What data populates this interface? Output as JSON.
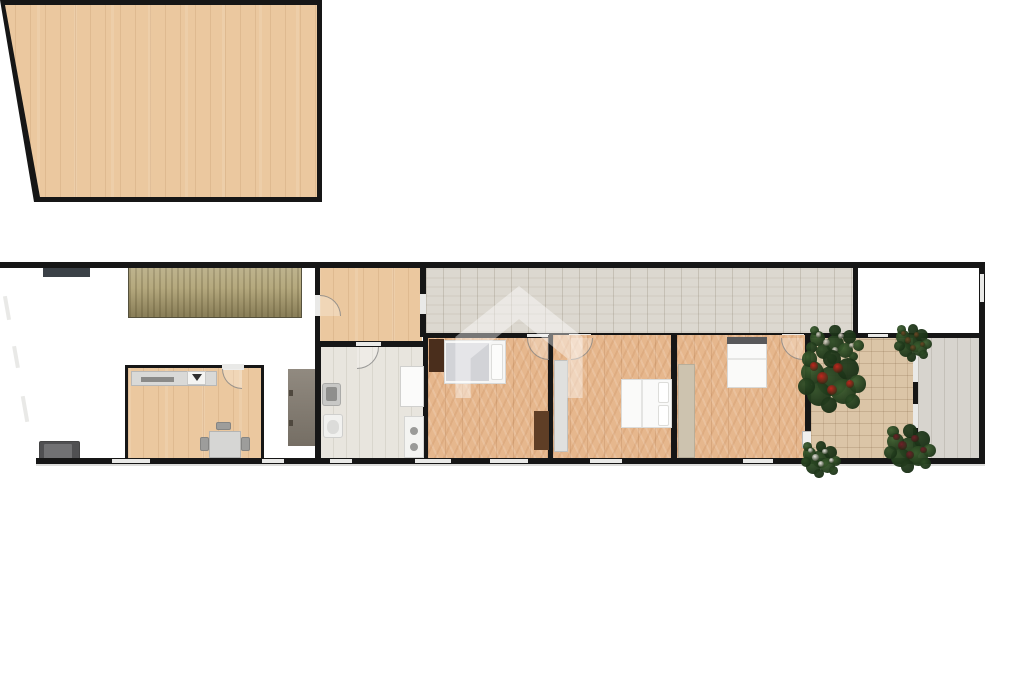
{
  "scene": {
    "type": "floor-plan",
    "description": "Top-down rendered floor plan of an elongated single-storey apartment with slanted left wall, staircase, kitchen, bathroom, three bedrooms, corridor, tiled terrace with plants and a side deck"
  },
  "colors": {
    "wall": "#161616",
    "oak": "#ebc89f",
    "herr": "#e6b78d",
    "corr": "#dcd8d0",
    "bath": "#e8e5de",
    "tile": "#dbc5a7",
    "deck": "#d7d4ce",
    "stairs": "#b5a97e",
    "sofa": "#505052",
    "counter": "#d9d9d7",
    "unit": "#857b6f",
    "darkwood": "#4a2e1c",
    "windowlight": "#e9e9e7"
  },
  "rooms": [
    {
      "name": "living-room",
      "floor": "oak-plank"
    },
    {
      "name": "kitchen",
      "floor": "oak-plank"
    },
    {
      "name": "vestibule",
      "floor": "oak-plank"
    },
    {
      "name": "corridor",
      "floor": "whitewashed-plank"
    },
    {
      "name": "bathroom",
      "floor": "pale-tile"
    },
    {
      "name": "bedroom-1",
      "floor": "herringbone-parquet"
    },
    {
      "name": "bedroom-2",
      "floor": "herringbone-parquet"
    },
    {
      "name": "bedroom-3",
      "floor": "herringbone-parquet"
    },
    {
      "name": "terrace",
      "floor": "beige-tile"
    },
    {
      "name": "side-deck",
      "floor": "grey-plank"
    },
    {
      "name": "courtyard",
      "floor": "none"
    }
  ],
  "furniture": [
    "staircase",
    "sofa",
    "kitchen-counter",
    "cooktop-sink-unit",
    "dining-table",
    "chairs",
    "tall-grey-unit",
    "washbasin",
    "toilet",
    "shower-tray",
    "washing-machine",
    "single-bed",
    "double-bed",
    "double-bed",
    "wardrobes",
    "dressers",
    "terrace-door"
  ],
  "plants": [
    {
      "x": 806,
      "y": 326,
      "w": 58,
      "h": 36,
      "accent": "mixed"
    },
    {
      "x": 800,
      "y": 352,
      "w": 64,
      "h": 58,
      "accent": "red"
    },
    {
      "x": 896,
      "y": 325,
      "w": 34,
      "h": 35,
      "accent": "brown"
    },
    {
      "x": 886,
      "y": 426,
      "w": 48,
      "h": 44,
      "accent": "darkred"
    },
    {
      "x": 802,
      "y": 442,
      "w": 38,
      "h": 34,
      "accent": "white"
    }
  ],
  "plant_palette": {
    "greens": [
      "#2e4d26",
      "#3c5e2f",
      "#243d1e"
    ],
    "red": "#bf271e",
    "darkred": "#6f2129",
    "white": "#e9e7e0",
    "brown": "#6b4a26",
    "mixed": "#d8d4c8"
  },
  "watermark": {
    "shape": "house-outline",
    "color": "#ffffff",
    "opacity": 0.42
  }
}
